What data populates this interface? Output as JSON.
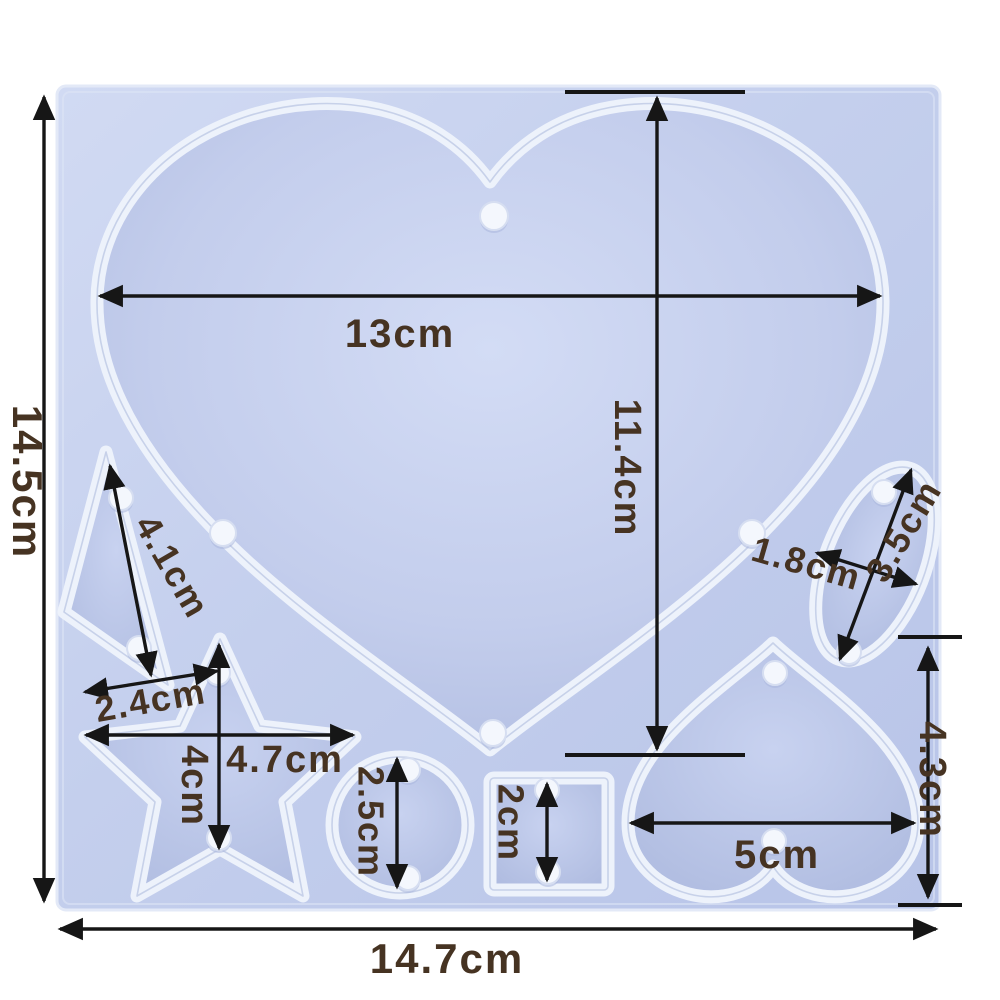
{
  "title": "Silicone pendant mold dimension diagram",
  "units": "cm",
  "colors": {
    "background": "#ffffff",
    "mold_base": "#c3cdec",
    "cavity_rim": "#edf2fb",
    "cavity_floor": "#b0bde0",
    "peg": "#f4f7fd",
    "dimension_line": "#161616",
    "label_text": "#463322"
  },
  "labels": {
    "overall_height": "14.5cm",
    "overall_width": "14.7cm",
    "large_heart_width": "13cm",
    "large_heart_height": "11.4cm",
    "triangle_length": "4.1cm",
    "triangle_base": "2.4cm",
    "star_width": "4.7cm",
    "star_height": "4cm",
    "circle_diameter": "2.5cm",
    "square_size": "2cm",
    "small_heart_width": "5cm",
    "small_heart_height": "4.3cm",
    "oval_length": "3.5cm",
    "oval_width": "1.8cm"
  },
  "dimensions": [
    {
      "shape": "mold base",
      "width": "14.7cm",
      "height": "14.5cm"
    },
    {
      "shape": "large heart",
      "width": "13cm",
      "height": "11.4cm"
    },
    {
      "shape": "triangle",
      "length": "4.1cm",
      "base": "2.4cm"
    },
    {
      "shape": "star",
      "width": "4.7cm",
      "height": "4cm"
    },
    {
      "shape": "circle",
      "diameter": "2.5cm"
    },
    {
      "shape": "square",
      "side": "2cm"
    },
    {
      "shape": "small heart",
      "width": "5cm",
      "height": "4.3cm"
    },
    {
      "shape": "oval",
      "length": "3.5cm",
      "width": "1.8cm"
    }
  ]
}
